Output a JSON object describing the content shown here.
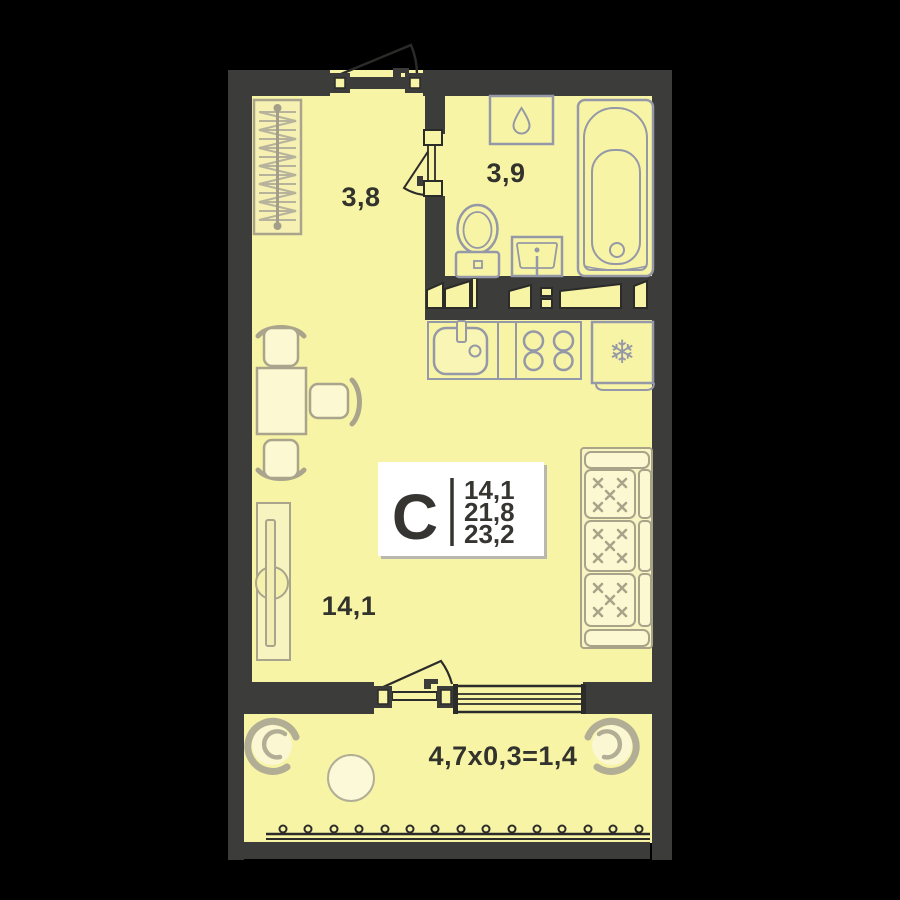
{
  "plan_title": "Studio apartment floor plan",
  "info_box": {
    "type_letter": "С",
    "area_values": [
      "14,1",
      "21,8",
      "23,2"
    ]
  },
  "rooms": {
    "hallway": {
      "label": "3,8"
    },
    "bathroom": {
      "label": "3,9"
    },
    "living": {
      "label": "14,1"
    },
    "balcony": {
      "label": "4,7x0,3=1,4"
    }
  },
  "icons": {
    "snowflake": "❄",
    "droplet-icon": "water-drop",
    "fridge-icon": "snowflake"
  },
  "colors": {
    "background": "#000000",
    "wall": "#3c3c3a",
    "floor": "#f8f4a6",
    "fixture_outline": "#9598a6",
    "furniture_outline": "#a9a48b",
    "furniture_fill": "#fbf8d2",
    "text": "#33332e",
    "info_box_bg": "#ffffff"
  }
}
